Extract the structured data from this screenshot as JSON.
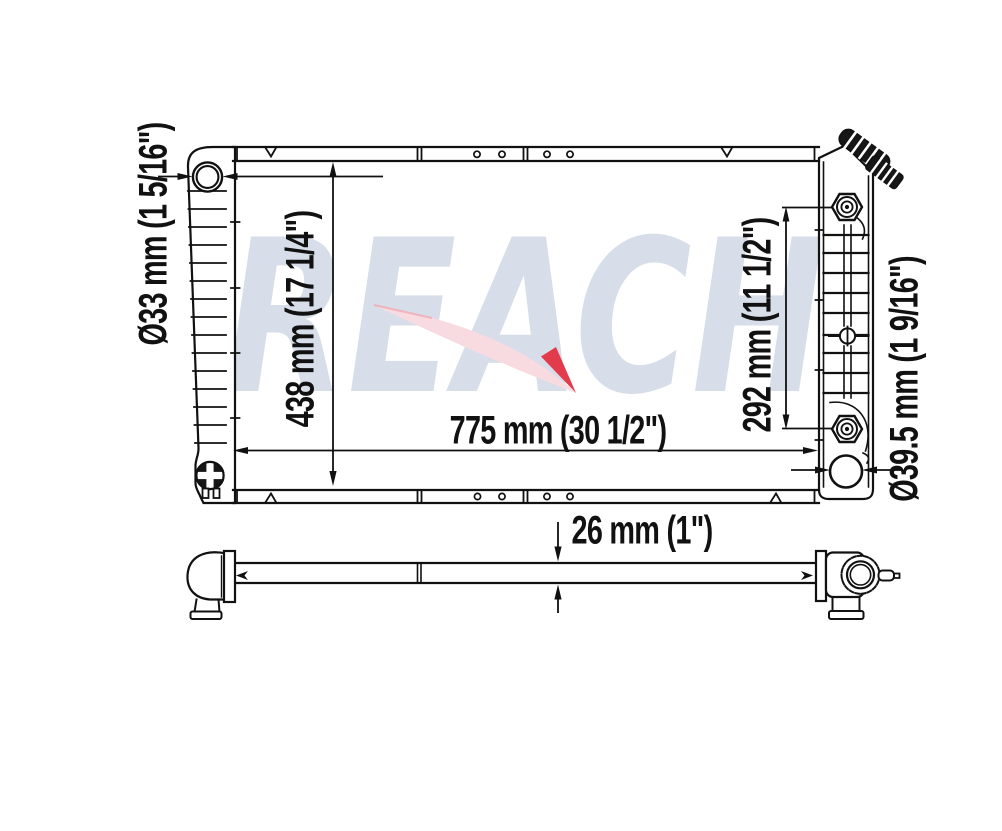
{
  "watermark": {
    "text": "REACH"
  },
  "colors": {
    "background": "#ffffff",
    "line": "#111111",
    "watermark_text": "#d7dee9",
    "watermark_arrow": "#f8dbe0",
    "watermark_arrow_tip": "#e23b4b"
  },
  "dimensions": {
    "inlet_diameter": {
      "label": "Ø33 mm (1 5/16\")",
      "mm": "Ø33",
      "inches": "1 5/16\""
    },
    "core_height": {
      "label": "438 mm (17 1/4\")",
      "mm": "438",
      "inches": "17 1/4\""
    },
    "core_width": {
      "label": "775 mm (30 1/2\")",
      "mm": "775",
      "inches": "30 1/2\""
    },
    "fitting_span": {
      "label": "292 mm (11 1/2\")",
      "mm": "292",
      "inches": "11 1/2\""
    },
    "outlet_diameter": {
      "label": "Ø39.5 mm (1 9/16\")",
      "mm": "Ø39.5",
      "inches": "1 9/16\""
    },
    "core_thickness": {
      "label": "26 mm (1\")",
      "mm": "26",
      "inches": "1\""
    }
  }
}
